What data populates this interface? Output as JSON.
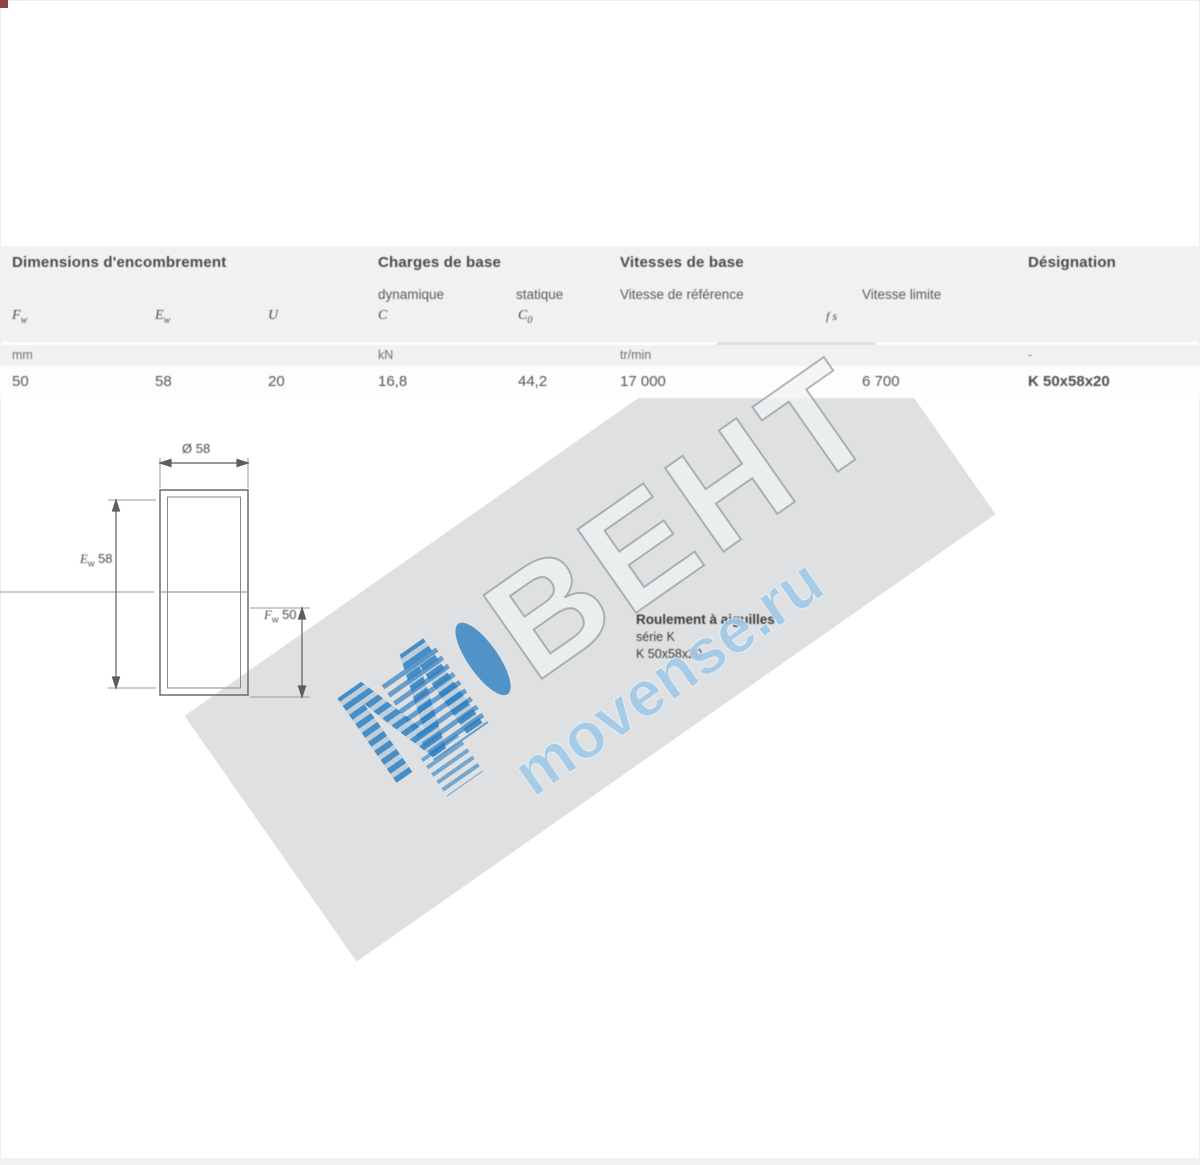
{
  "table": {
    "headers": {
      "dimensions": "Dimensions d'encombrement",
      "loads": "Charges de base",
      "speeds": "Vitesses de base",
      "designation": "Désignation",
      "dynamic": "dynamique",
      "static": "statique",
      "ref_speed": "Vitesse de référence",
      "lim_speed": "Vitesse limite"
    },
    "symbols": {
      "fw_main": "F",
      "fw_sub": "w",
      "ew_main": "E",
      "ew_sub": "w",
      "u": "U",
      "c": "C",
      "c0_main": "C",
      "c0_sub": "0",
      "speed_marks": "f s"
    },
    "units": {
      "dimensions": "mm",
      "loads": "kN",
      "speeds": "tr/min",
      "designation": "-"
    },
    "row": {
      "fw": "50",
      "ew": "58",
      "u": "20",
      "c": "16,8",
      "c0": "44,2",
      "ref_speed": "17 000",
      "lim_speed": "6 700",
      "designation": "K 50x58x20"
    }
  },
  "drawing": {
    "dim_top": "Ø 58",
    "dim_left_sym": "E",
    "dim_left_sub": "w",
    "dim_left_val": "58",
    "dim_right_sym": "F",
    "dim_right_sub": "w",
    "dim_right_val": "50"
  },
  "note": {
    "title": "Roulement à aiguilles",
    "line2": "série K",
    "line3": "K 50x58x20"
  },
  "watermark": {
    "letter": "М",
    "brand": "ВЕНТ",
    "site": "movense.ru",
    "blue": "#2e7fc1",
    "gray": "#b9bdc1"
  }
}
